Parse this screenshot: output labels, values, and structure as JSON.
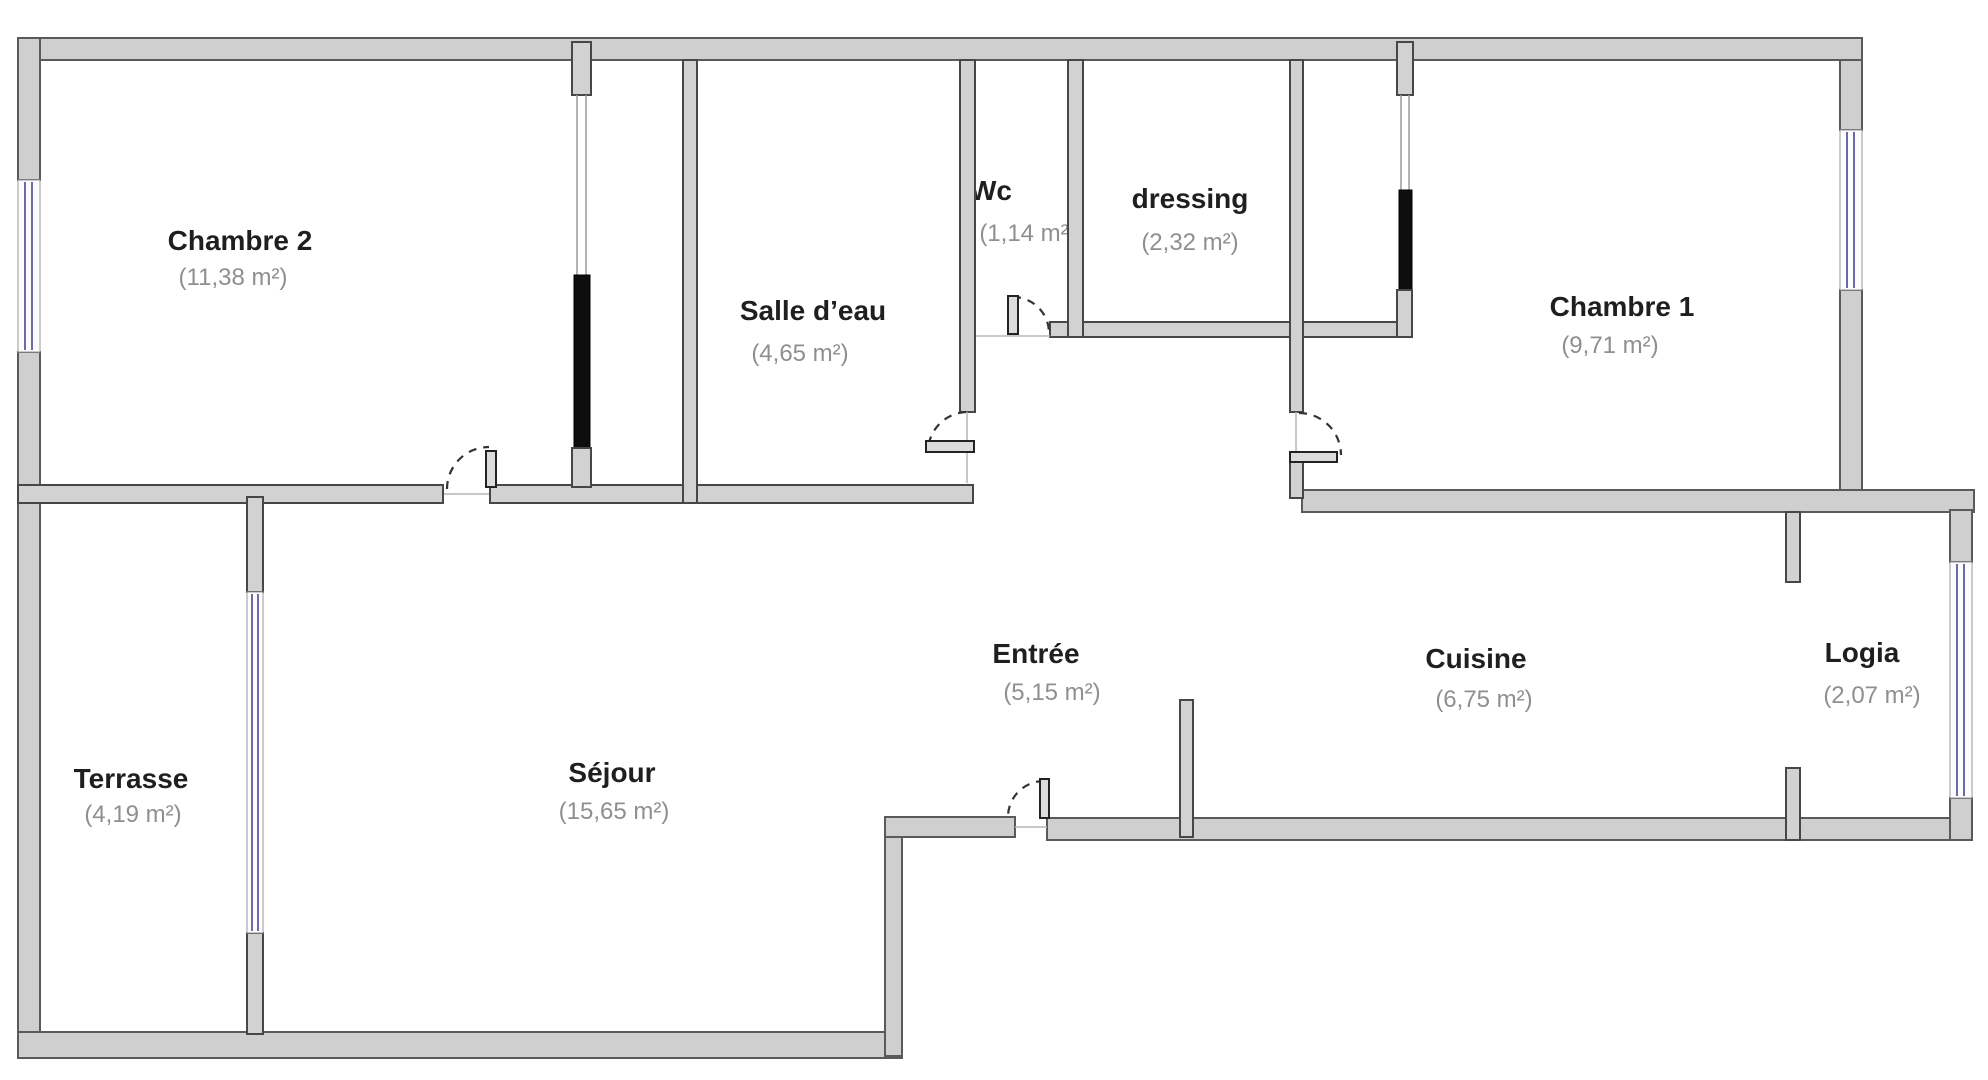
{
  "plan": {
    "type": "apartment-floorplan",
    "language": "fr",
    "colors": {
      "background": "#ffffff",
      "wall_fill": "#d2d2d2",
      "wall_stroke": "#474747",
      "window_accent": "#6b6bab",
      "sliding_panel": "#0e0e0e",
      "room_label": "#1f1f1f",
      "area_label": "#8f8f8f"
    },
    "rooms": {
      "chambre2": {
        "name": "Chambre 2",
        "area": "(11,38 m²)"
      },
      "salle_deau": {
        "name": "Salle d’eau",
        "area": "(4,65 m²)"
      },
      "wc": {
        "name": "Wc",
        "area": "(1,14 m²)"
      },
      "dressing": {
        "name": "dressing",
        "area": "(2,32 m²)"
      },
      "chambre1": {
        "name": "Chambre 1",
        "area": "(9,71 m²)"
      },
      "terrasse": {
        "name": "Terrasse",
        "area": "(4,19 m²)"
      },
      "sejour": {
        "name": "Séjour",
        "area": "(15,65 m²)"
      },
      "entree": {
        "name": "Entrée",
        "area": "(5,15 m²)"
      },
      "cuisine": {
        "name": "Cuisine",
        "area": "(6,75 m²)"
      },
      "logia": {
        "name": "Logia",
        "area": "(2,07 m²)"
      }
    }
  }
}
